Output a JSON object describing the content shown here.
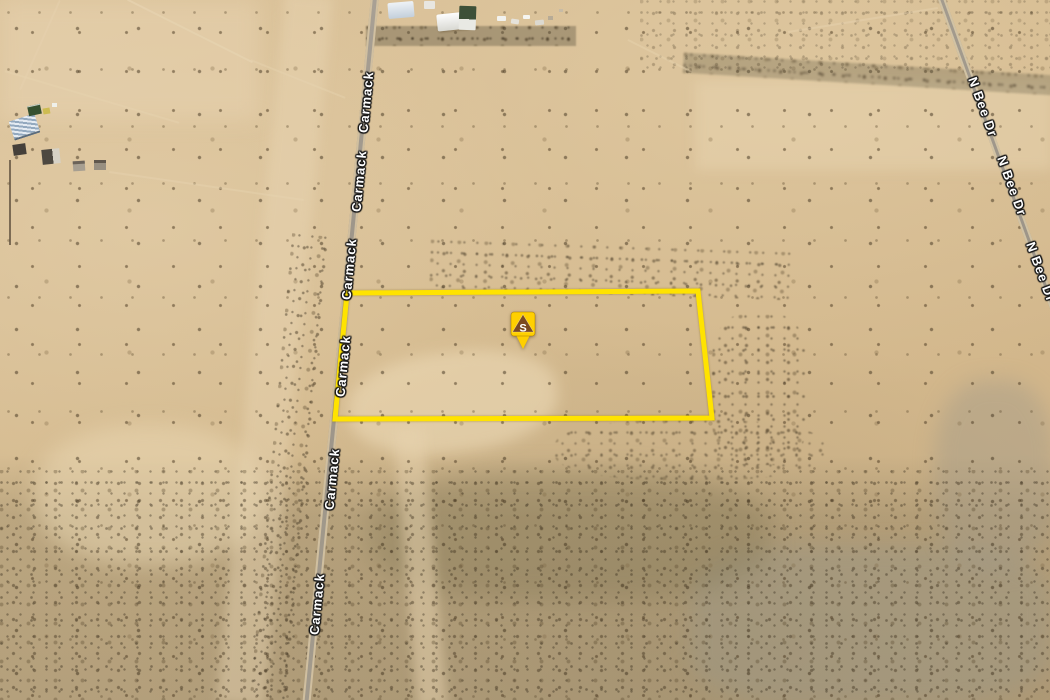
{
  "map": {
    "kind": "satellite-imagery",
    "roads": {
      "carmack": "Carmack",
      "n_bee": "N Bee Dr"
    },
    "marker": {
      "letter": "S",
      "icon": "triangle-pin-icon"
    },
    "parcel": {
      "points": "347,293 698,291 712,418 335,419"
    },
    "colors": {
      "parcel_outline": "#FFE300",
      "marker_fill": "#FFD000",
      "marker_glyph_fill": "#7B4A21",
      "marker_letter": "#FFFFFF",
      "terrain": "#D5BB92",
      "road": "#9C9488",
      "road_label": "#FFFFFF"
    }
  }
}
